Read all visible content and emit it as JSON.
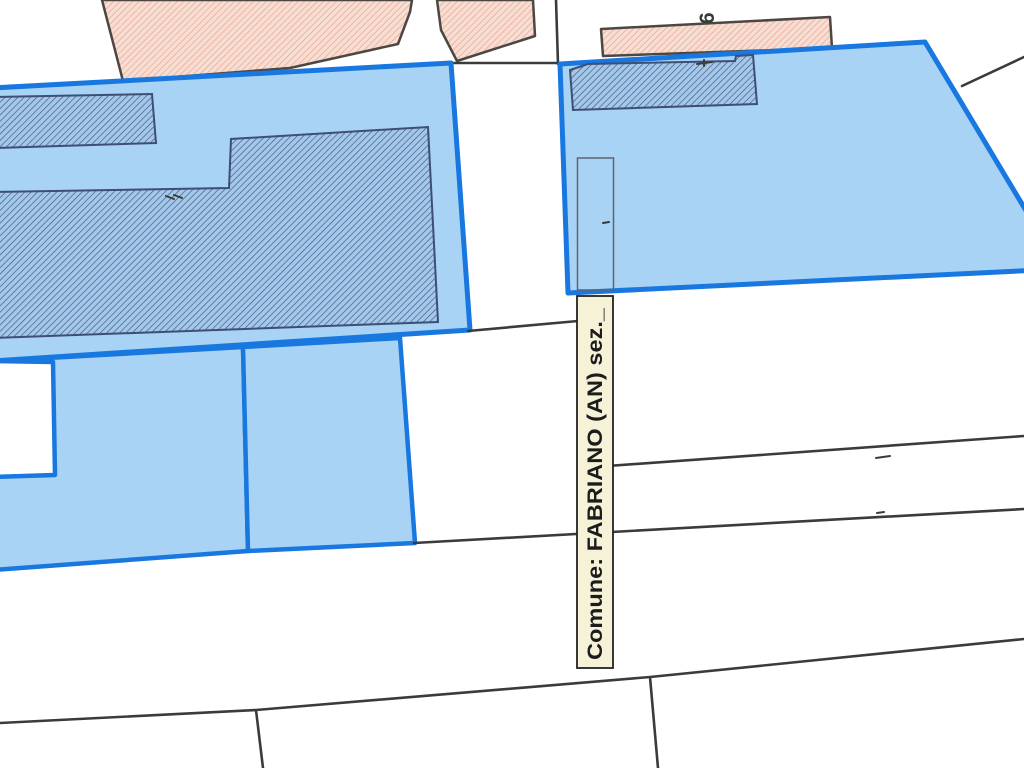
{
  "map": {
    "title": "Cadastral map viewer",
    "label_box": {
      "text": "Comune: FABRIANO (AN) sez._"
    },
    "parcel_number": {
      "text": "6"
    },
    "colors": {
      "parcel_fill": "#a9d3f5",
      "parcel_border": "#1878e0",
      "building_hatch_base": "#a3c8ea",
      "building_hatch_line": "#41557c",
      "building_outline": "#3d4f73",
      "pink_hatch_base": "#f8ded2",
      "pink_hatch_line": "#e3a18f",
      "pink_outline": "#4d4743",
      "boundary_line": "#3b3b3b",
      "label_bg": "#f6f2d8",
      "label_border": "#222222",
      "label_text": "#1c1c1c"
    }
  }
}
